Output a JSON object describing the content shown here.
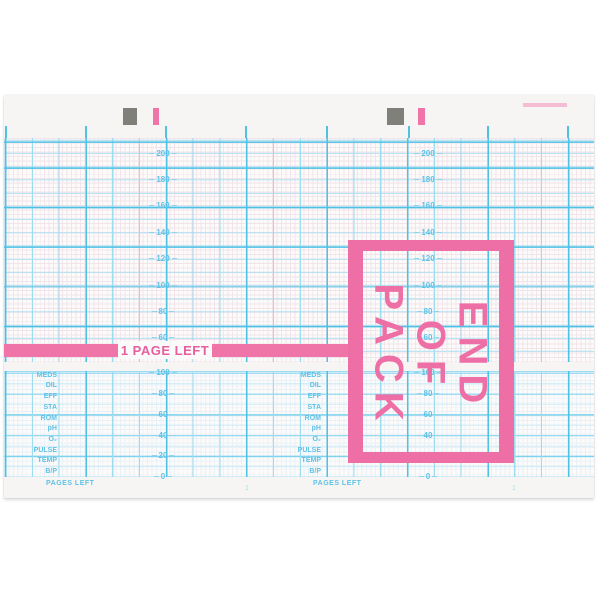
{
  "meta": {
    "description": "Blank fetal monitor (CTG) chart recorder paper, end-of-pack warning sheet",
    "colors": {
      "accent_pink": "#ee6fa5",
      "banner_text_pink": "#e75f9e",
      "grid_cyan_heavy": "#4fc1e5",
      "grid_cyan_medium": "#9edcf0",
      "label_cyan": "#5ec2e6",
      "registration_gray": "#80807a",
      "paper": "#f6f5f3"
    }
  },
  "scales": {
    "upper": [
      "200",
      "180",
      "160",
      "140",
      "120",
      "100",
      "80",
      "60"
    ],
    "lower": [
      "100",
      "80",
      "60",
      "40",
      "20",
      "0"
    ]
  },
  "rows": {
    "labels": [
      "MEDS",
      "DIL",
      "EFF",
      "STA",
      "ROM",
      "pH",
      "O₂",
      "PULSE",
      "TEMP",
      "B/P"
    ],
    "pages_left_label": "PAGES LEFT"
  },
  "footer": {
    "page_number": "1"
  },
  "banner": {
    "text": "1 PAGE LEFT"
  },
  "end_of_pack": {
    "lines": [
      "END",
      "OF",
      "PACK"
    ]
  },
  "chart_data": {
    "type": "line",
    "title": "",
    "series": [],
    "note_visible_content": "blank recording grid, no plotted traces",
    "upper_axis": {
      "tick_labels": [
        200,
        180,
        160,
        140,
        120,
        100,
        80,
        60
      ]
    },
    "lower_axis": {
      "tick_labels": [
        100,
        80,
        60,
        40,
        20,
        0
      ]
    },
    "annotations": [
      "1 PAGE LEFT",
      "END OF PACK"
    ],
    "grid": "on",
    "annotation_rows": [
      "MEDS",
      "DIL",
      "EFF",
      "STA",
      "ROM",
      "pH",
      "O₂",
      "PULSE",
      "TEMP",
      "B/P",
      "PAGES LEFT"
    ]
  }
}
